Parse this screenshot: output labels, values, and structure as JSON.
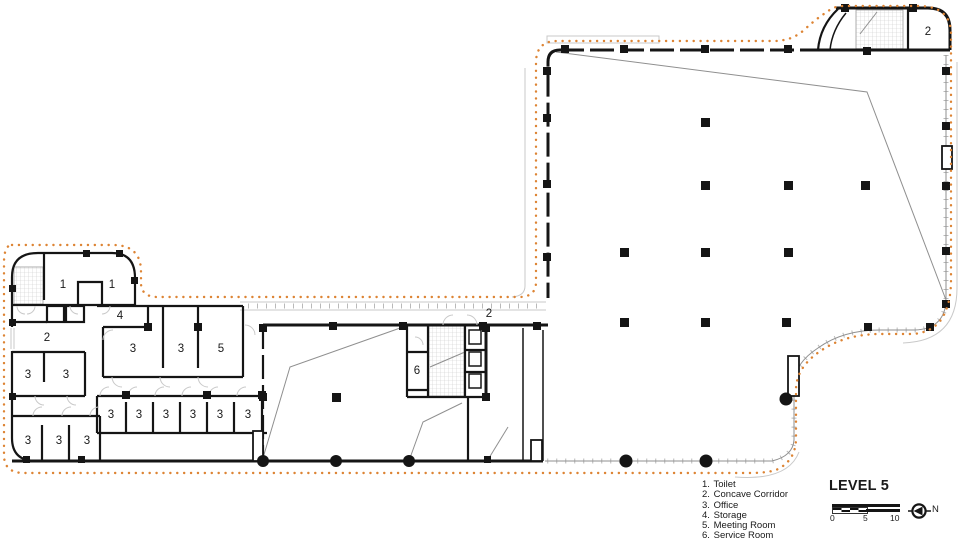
{
  "title": "LEVEL 5",
  "legend": {
    "items": [
      {
        "num": "1.",
        "label": "Toilet"
      },
      {
        "num": "2.",
        "label": "Concave Corridor"
      },
      {
        "num": "3.",
        "label": "Office"
      },
      {
        "num": "4.",
        "label": "Storage"
      },
      {
        "num": "5.",
        "label": "Meeting Room"
      },
      {
        "num": "6.",
        "label": "Service Room"
      }
    ]
  },
  "scale_bar": {
    "ticks": [
      "0",
      "5",
      "10"
    ]
  },
  "north": {
    "label": "N"
  },
  "colors": {
    "wall": "#151515",
    "outline_dots": "#dd8434",
    "thin_line": "#8f8f8f",
    "hatch": "#c9c9c9"
  },
  "room_labels": [
    {
      "text": "1",
      "x": 63,
      "y": 288
    },
    {
      "text": "1",
      "x": 112,
      "y": 288
    },
    {
      "text": "2",
      "x": 47,
      "y": 341
    },
    {
      "text": "4",
      "x": 120,
      "y": 319
    },
    {
      "text": "3",
      "x": 133,
      "y": 352
    },
    {
      "text": "3",
      "x": 181,
      "y": 352
    },
    {
      "text": "5",
      "x": 221,
      "y": 352
    },
    {
      "text": "3",
      "x": 28,
      "y": 378
    },
    {
      "text": "3",
      "x": 66,
      "y": 378
    },
    {
      "text": "3",
      "x": 28,
      "y": 444
    },
    {
      "text": "3",
      "x": 59,
      "y": 444
    },
    {
      "text": "3",
      "x": 87,
      "y": 444
    },
    {
      "text": "3",
      "x": 111,
      "y": 418
    },
    {
      "text": "3",
      "x": 139,
      "y": 418
    },
    {
      "text": "3",
      "x": 166,
      "y": 418
    },
    {
      "text": "3",
      "x": 193,
      "y": 418
    },
    {
      "text": "3",
      "x": 220,
      "y": 418
    },
    {
      "text": "3",
      "x": 248,
      "y": 418
    },
    {
      "text": "6",
      "x": 417,
      "y": 374
    },
    {
      "text": "2",
      "x": 489,
      "y": 317
    },
    {
      "text": "2",
      "x": 928,
      "y": 35
    }
  ]
}
